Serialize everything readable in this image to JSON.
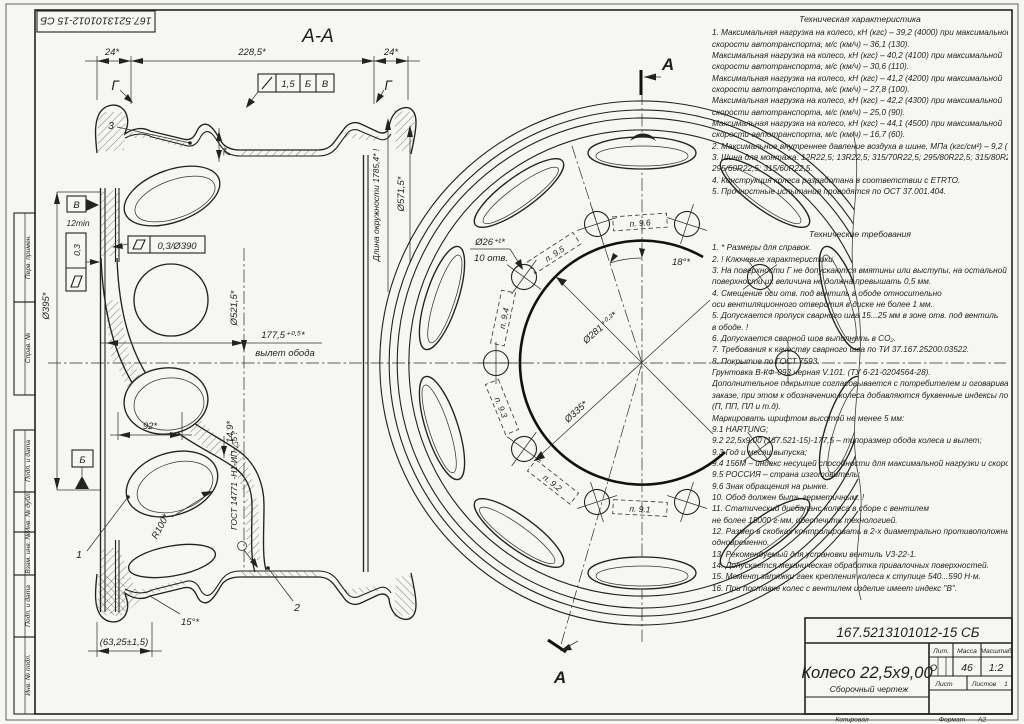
{
  "doc": {
    "number_stamp": "167.5213101012-15 СБ"
  },
  "frame": {
    "side_labels": [
      "Перв. примен.",
      "Справ. №",
      "Подп. и дата",
      "Инв. № дубл.",
      "Взам. инв. №",
      "Подп. и дата",
      "Инв. № подл."
    ],
    "copied_label": "Копировал",
    "format_label": "Формат",
    "format_value": "А2"
  },
  "section_view": {
    "title": "А-А",
    "dim_24_left": "24*",
    "dim_228_5": "228,5*",
    "dim_24_right": "24*",
    "surface_g_left": "Г",
    "surface_g_right": "Г",
    "item_1": "1",
    "item_2": "2",
    "item_3": "3",
    "tol_sym": "/",
    "tol_val": "1,5",
    "tol_datum1": "Б",
    "tol_datum2": "В",
    "dim_7": "7*",
    "circumference": "Длина окружности 1785,4* !",
    "dia_571_5": "Ø571,5*",
    "datum_v": "В",
    "dim_12min": "12min",
    "flatness_0_3": "0,3",
    "flat_sym": "▱",
    "flatness_0_3_390": "0,3/Ø390",
    "dia_395": "Ø395*",
    "dia_521_5": "Ø521,5*",
    "dim_177_5": "177,5⁺⁰·⁵*",
    "offset_label": "вылет обода",
    "dim_92": "92*",
    "dim_14_9": "14,9*",
    "r_100": "R100*",
    "weld_spec": "ГОСТ 14771 -Н1-ИП-△5 !",
    "datum_b": "Б",
    "dim_15deg": "15°*",
    "dim_63_25": "(63,25±1,5)"
  },
  "front_view": {
    "cut_label_top": "А",
    "cut_label_bottom": "А",
    "dia_26": "Ø26⁺¹*",
    "holes_count": "10 отв.",
    "dim_18deg": "18°*",
    "dia_281": "Ø281⁺⁰·²*",
    "dia_335": "Ø335*",
    "mark_9_1": "п. 9.1",
    "mark_9_2": "п. 9.2",
    "mark_9_3": "п. 9.3",
    "mark_9_4": "п. 9.4",
    "mark_9_5": "п. 9.5",
    "mark_9_6": "п. 9.6"
  },
  "notes": {
    "tech_char_title": "Техническая характеристика",
    "tech_char_lines": [
      "1. Максимальная нагрузка на колесо, кН (кгс) – 39,2 (4000) при максимальной",
      "скорости автотранспорта, м/с (км/ч) – 36,1 (130).",
      "Максимальная нагрузка на колесо, кН (кгс) – 40,2 (4100) при максимальной",
      "скорости автотранспорта, м/с (км/ч) – 30,6 (110).",
      "Максимальная нагрузка на колесо, кН (кгс) – 41,2 (4200) при максимальной",
      "скорости автотранспорта, м/с (км/ч) – 27,8 (100).",
      "Максимальная нагрузка на колесо, кН (кгс) – 42,2 (4300) при максимальной",
      "скорости автотранспорта, м/с (км/ч) – 25,0 (90).",
      "Максимальная нагрузка на колесо, кН (кгс) – 44,1 (4500) при максимальной",
      "скорости автотранспорта, м/с (км/ч) – 16,7 (60).",
      "2. Максимальное внутреннее давление воздуха в шине, МПа (кгс/см²) – 9,2 (9,4).",
      "3. Шина для монтажа: 12R22,5; 13R22,5; 315/70R22,5; 295/80R22,5; 315/80R22,5;",
      "295/60R22,5; 315/60R22,5.",
      "4. Конструкция колеса разработана в соответствии с ETRTO.",
      "5. Прочностные испытания проводятся по ОСТ 37.001.404."
    ],
    "tech_req_title": "Технические требования",
    "tech_req_lines": [
      "1. * Размеры для справок.",
      "2. ! Ключевые характеристики.",
      "3. На поверхности Г не допускаются вмятины или выступы, на остальной",
      "поверхности их величина не должна превышать 0,5 мм.",
      "4. Смещение оси отв. под вентиль в ободе относительно",
      "оси вентиляционного отверстия в диске не более 1 мм.",
      "5. Допускается пропуск сварного шва 15...25 мм в зоне отв. под вентиль",
      "в ободе. !",
      "6. Допускается сварной шов выполнять в CO₂.",
      "7. Требования к качеству сварного шва по ТИ 37.167.25200.03522.",
      "8. Покрытие по ГОСТ 7593.",
      "Грунтовка В-КФ-093  черная V.101. (ТУ 6-21-0204564-28).",
      "Дополнительное покрытие согласовывается с потребителем и оговаривается в",
      "заказе, при этом к обозначению колеса добавляются буквенные индексы покрытия",
      "(П, ПП, ПЛ и т.д).",
      "Маркировать шрифтом высотой не менее 5 мм:",
      "9.1 HARTUNG;",
      "9.2 22,5x9,00 (167.521-15)-177,5 – типоразмер обода колеса и вылет;",
      "9.3 Год и месяц выпуска;",
      "9.4 156М – индекс несущей способности для максимальной нагрузки и скорости;",
      "9.5 РОССИЯ – страна изготовитель;",
      "9.6 Знак обращения на рынке.",
      "10. Обод должен быть герметичным. !",
      "11. Статический дисбаланс колеса в сборе с вентилем",
      "не более 15000 г·мм, обеспечить технологией.",
      "12. Размер в скобках контролировать в 2-х диаметрально противоположных точках",
      "одновременно.",
      "13. Рекомендуемый для установки вентиль V3-22-1.",
      "14. Допускается механическая обработка привалочных поверхностей.",
      "15. Момент затяжки гаек крепления колеса к ступице 540...590 Н·м.",
      "16. При поставке колес с вентилем изделие имеет индекс \"В\"."
    ]
  },
  "title_block": {
    "doc_number": "167.5213101012-15 СБ",
    "product": "Колесо 22,5x9,00",
    "doc_type": "Сборочный чертеж",
    "lit_label": "Лит.",
    "mass_label": "Масса",
    "scale_label": "Масштаб",
    "lit": "О",
    "mass": "46",
    "scale": "1:2",
    "sheet_label": "Лист",
    "sheets_label": "Листов",
    "sheets": "1"
  }
}
